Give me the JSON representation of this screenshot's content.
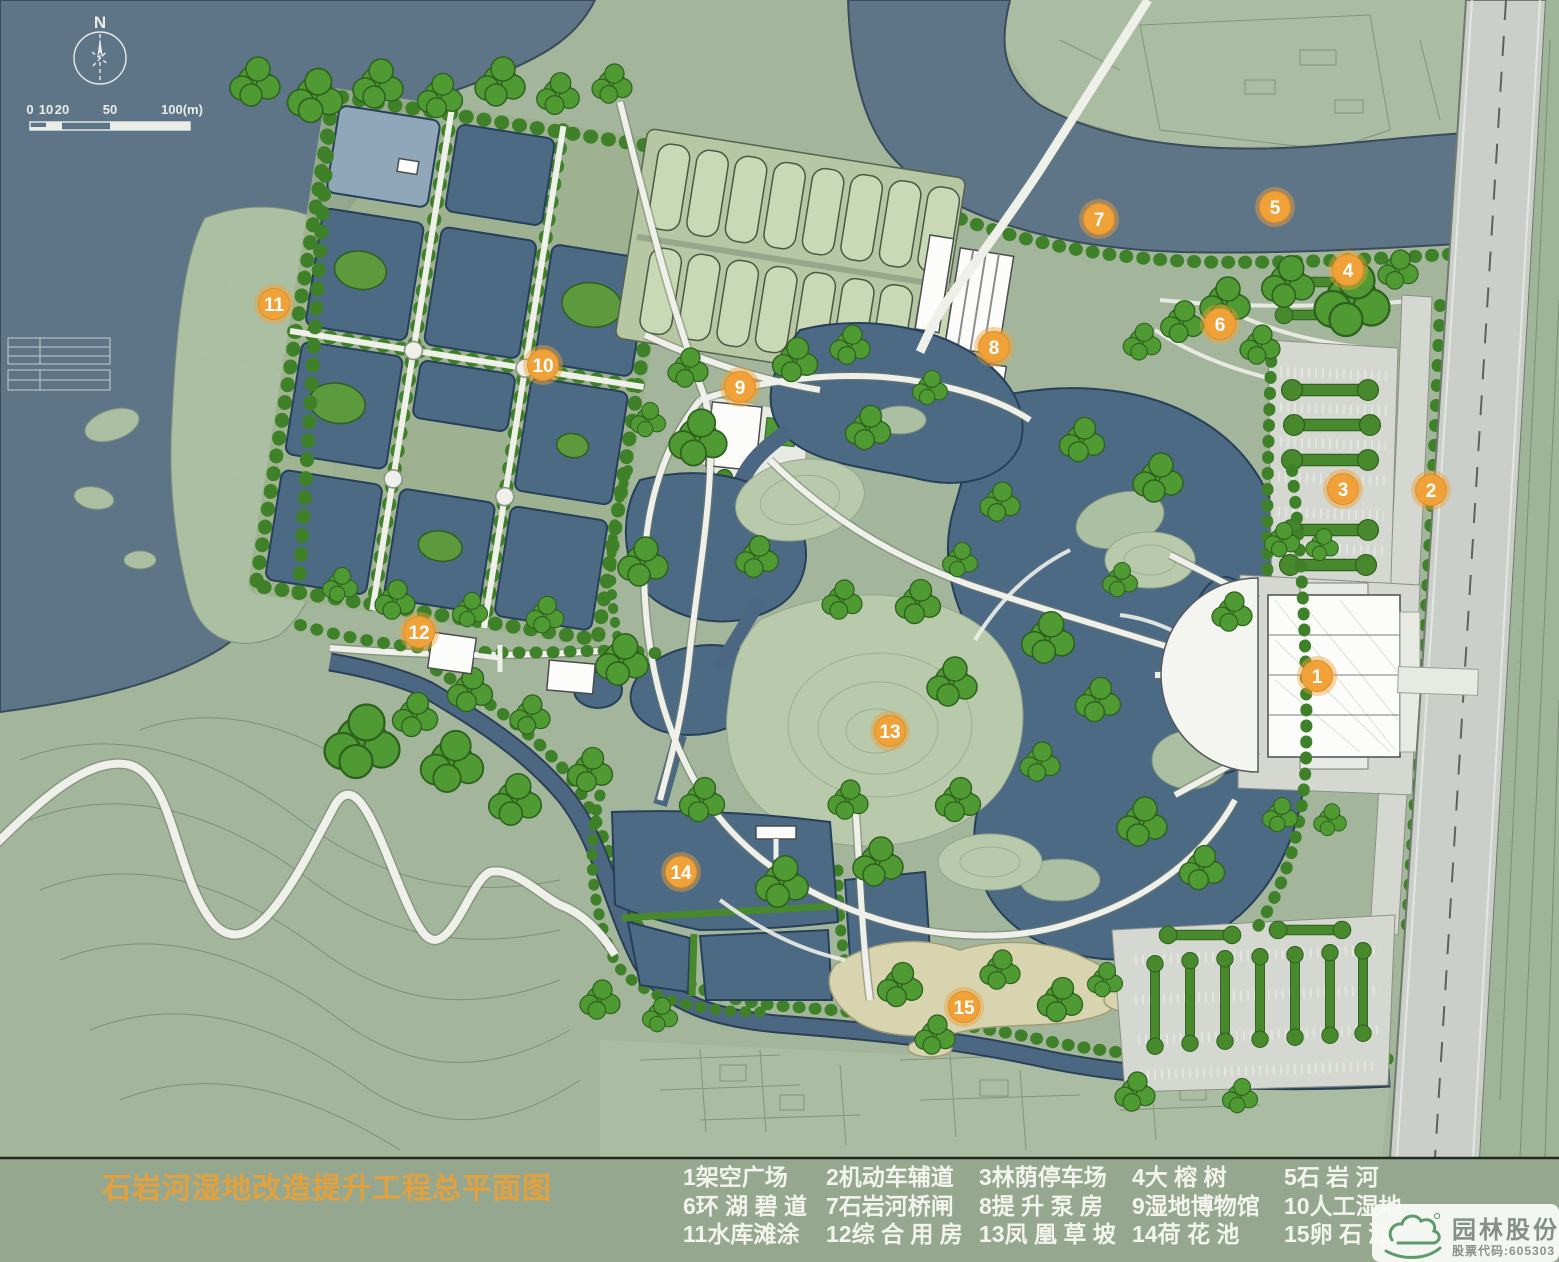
{
  "title": {
    "text": "石岩河湿地改造提升工程总平面图"
  },
  "compass": {
    "label": "N"
  },
  "scale_bar": {
    "ticks": [
      "0",
      "10",
      "20",
      "50",
      "100(m)"
    ]
  },
  "legend": {
    "items": [
      {
        "num": "1",
        "label": "架空广场",
        "row": 0,
        "col": 0
      },
      {
        "num": "2",
        "label": "机动车辅道",
        "row": 0,
        "col": 1
      },
      {
        "num": "3",
        "label": "林荫停车场",
        "row": 0,
        "col": 2
      },
      {
        "num": "4",
        "label": "大 榕 树",
        "row": 0,
        "col": 3
      },
      {
        "num": "5",
        "label": "石 岩 河",
        "row": 0,
        "col": 4
      },
      {
        "num": "6",
        "label": "环 湖 碧 道",
        "row": 1,
        "col": 0
      },
      {
        "num": "7",
        "label": "石岩河桥闸",
        "row": 1,
        "col": 1
      },
      {
        "num": "8",
        "label": "提 升 泵 房",
        "row": 1,
        "col": 2
      },
      {
        "num": "9",
        "label": "湿地博物馆",
        "row": 1,
        "col": 3
      },
      {
        "num": "10",
        "label": "人工湿地",
        "row": 1,
        "col": 4
      },
      {
        "num": "11",
        "label": "水库滩涂",
        "row": 2,
        "col": 0
      },
      {
        "num": "12",
        "label": "综 合 用 房",
        "row": 2,
        "col": 1
      },
      {
        "num": "13",
        "label": "凤 凰 草 坡",
        "row": 2,
        "col": 2
      },
      {
        "num": "14",
        "label": "荷 花 池",
        "row": 2,
        "col": 3
      },
      {
        "num": "15",
        "label": "卵 石 滩",
        "row": 2,
        "col": 4
      }
    ]
  },
  "markers": [
    {
      "n": "1",
      "x": 1317,
      "y": 676
    },
    {
      "n": "2",
      "x": 1431,
      "y": 490
    },
    {
      "n": "3",
      "x": 1343,
      "y": 489
    },
    {
      "n": "4",
      "x": 1348,
      "y": 270
    },
    {
      "n": "5",
      "x": 1275,
      "y": 207
    },
    {
      "n": "6",
      "x": 1220,
      "y": 324
    },
    {
      "n": "7",
      "x": 1099,
      "y": 219
    },
    {
      "n": "8",
      "x": 994,
      "y": 347
    },
    {
      "n": "9",
      "x": 740,
      "y": 387
    },
    {
      "n": "10",
      "x": 543,
      "y": 365
    },
    {
      "n": "11",
      "x": 274,
      "y": 304
    },
    {
      "n": "12",
      "x": 419,
      "y": 632
    },
    {
      "n": "13",
      "x": 890,
      "y": 731
    },
    {
      "n": "14",
      "x": 681,
      "y": 872
    },
    {
      "n": "15",
      "x": 964,
      "y": 1007
    }
  ],
  "logo": {
    "company": "园林股份",
    "stock_code": "股票代码:605303"
  },
  "colors": {
    "marker": "#f0a238",
    "title": "#e1a13e",
    "water": "#5e7487",
    "pond": "#4d6a85",
    "land": "#a3b69b",
    "tree": "#4f9a33",
    "road": "#cbcfca",
    "path": "#eef0e9",
    "legend_text": "#f2f4ed",
    "pebble": "#d8d4b0"
  }
}
